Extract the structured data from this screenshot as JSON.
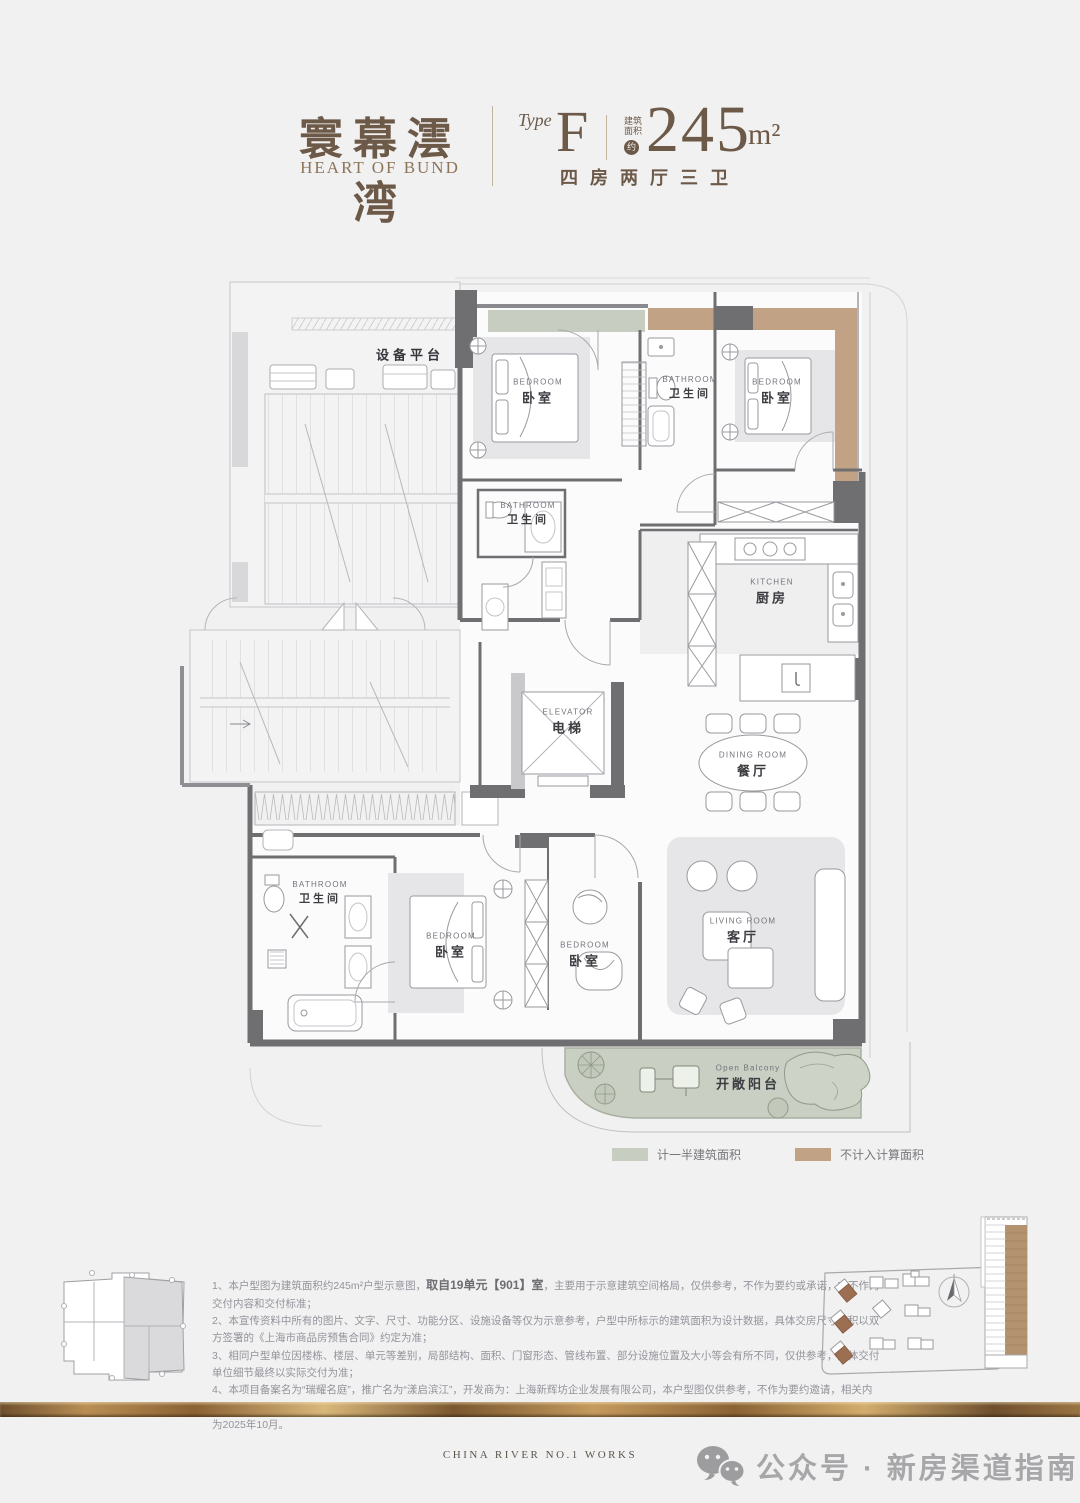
{
  "header": {
    "brand_cn": "寰幕澐湾",
    "brand_en": "HEART OF BUND",
    "type_label": "Type",
    "type_value": "F",
    "area_prefix_1": "建筑",
    "area_prefix_2": "面积",
    "area_approx": "约",
    "area_number": "245",
    "area_unit": "m²",
    "layout_spec": "四房两厅三卫"
  },
  "plan": {
    "equipment_platform": "设备平台",
    "rooms": [
      {
        "en": "BEDROOM",
        "cn": "卧室"
      },
      {
        "en": "BATHROOM",
        "cn": "卫生间"
      },
      {
        "en": "BEDROOM",
        "cn": "卧室"
      },
      {
        "en": "BATHROOM",
        "cn": "卫生间"
      },
      {
        "en": "KITCHEN",
        "cn": "厨房"
      },
      {
        "en": "ELEVATOR",
        "cn": "电梯"
      },
      {
        "en": "DINING ROOM",
        "cn": "餐厅"
      },
      {
        "en": "LIVING ROOM",
        "cn": "客厅"
      },
      {
        "en": "BATHROOM",
        "cn": "卫生间"
      },
      {
        "en": "BEDROOM",
        "cn": "卧室"
      },
      {
        "en": "BEDROOM",
        "cn": "卧室"
      },
      {
        "en": "Open Balcony",
        "cn": "开敞阳台"
      }
    ]
  },
  "legend": [
    {
      "label": "计一半建筑面积",
      "color": "#c7cdc0"
    },
    {
      "label": "不计入计算面积",
      "color": "#c2a284"
    }
  ],
  "notes": {
    "n1_pre": "1、本户型图为建筑面积约245m²户型示意图，",
    "n1_bold": "取自19单元【901】室",
    "n1_post": "，主要用于示意建筑空间格局，仅供参考，不作为要约或承诺，亦不作为交付内容和交付标准；",
    "n2": "2、本宣传资料中所有的图片、文字、尺寸、功能分区、设施设备等仅为示意参考，户型中所标示的建筑面积为设计数据，具体交房尺寸面积以双方签署的《上海市商品房预售合同》约定为准；",
    "n3": "3、相同户型单位因楼栋、楼层、单元等差别，局部结构、面积、门窗形态、管线布置、部分设施位置及大小等会有所不同，仅供参考，具体交付单位细节最终以实际交付为准；",
    "n4": "4、本项目备案名为“瑞耀名庭”，推广名为“漾启滨江”，开发商为：上海新辉坊企业发展有限公司，本户型图仅供参考，不作为要约邀请，相关内容不排除因政府相关规划、规定及开发商未能知晓的原因而发生变化，本公司保留对宣传资料修改的权利,敬请留意最新资料。本户型图制作时间为2025年10月。"
  },
  "footer": {
    "works": "CHINA RIVER NO.1 WORKS",
    "wechat": "公众号 · 新房渠道指南"
  },
  "colors": {
    "band_half_area": "#c7cdc0",
    "band_excluded": "#c2a284",
    "wall": "#6f6f72",
    "title_brown": "#6d5947",
    "gold": "#a9834f"
  }
}
